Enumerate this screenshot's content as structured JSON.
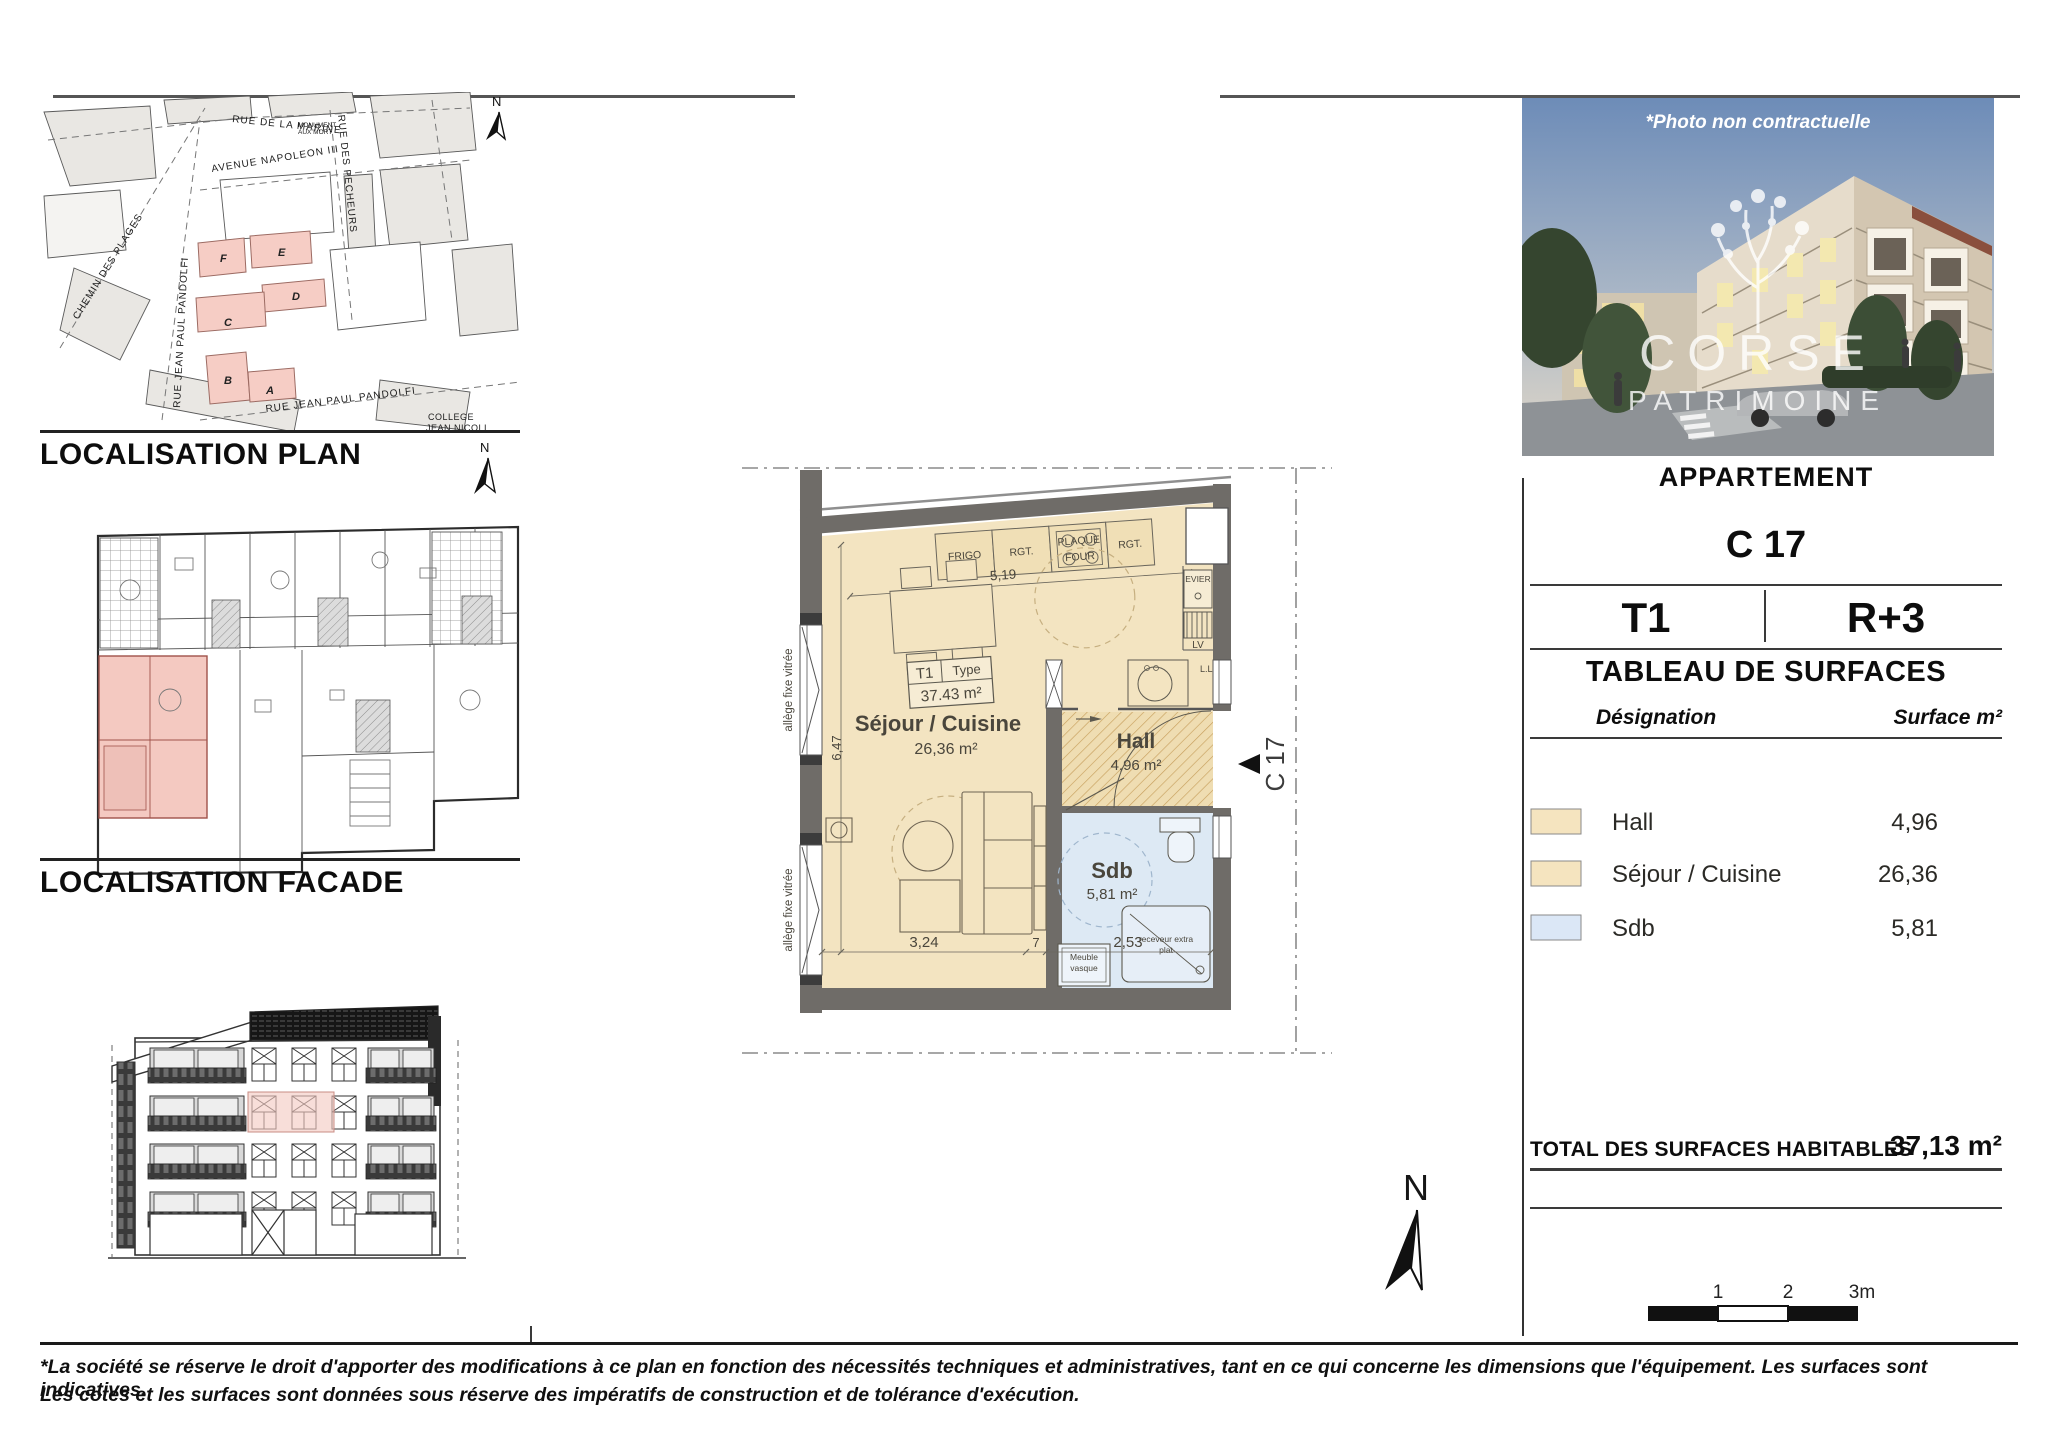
{
  "colors": {
    "room_tan": "#f3e4c1",
    "counter_tan": "#f0dfb6",
    "sdb_blue": "#dde9f4",
    "wall_gray": "#6f6c68",
    "pink_highlight": "#f4c9c1",
    "pink_border": "#a85b52",
    "map_block_gray": "#e9e7e3",
    "label_ink": "#4a463c"
  },
  "map": {
    "title": "LOCALISATION PLAN",
    "north_label": "N",
    "streets": {
      "marine": "RUE DE LA MARINE",
      "napoleon": "AVENUE  NAPOLEON  III",
      "monument_1": "MONUMENT",
      "monument_2": "AUX MORT",
      "chemin": "CHEMIN  DES  PLAGES",
      "pandolfi_v": "RUE  JEAN  PAUL  PANDOLFI",
      "pandolfi_d": "RUE   JEAN   PAUL   PANDOLFI",
      "pecheurs": "RUE  DES  PECHEURS",
      "college_1": "COLLEGE",
      "college_2": "JEAN NICOLI"
    },
    "buildings": {
      "a": "A",
      "b": "B",
      "c": "C",
      "d": "D",
      "e": "E",
      "f": "F"
    }
  },
  "facade": {
    "title": "LOCALISATION FACADE"
  },
  "photo": {
    "caption": "*Photo non contractuelle",
    "brand_top": "CORSE",
    "brand_bottom": "PATRIMOINE"
  },
  "plan": {
    "type_label": "T1",
    "type_word": "Type",
    "type_area": "37.43 m²",
    "sejour_label": "Séjour / Cuisine",
    "sejour_area": "26,36 m²",
    "hall_label": "Hall",
    "hall_area": "4,96 m²",
    "sdb_label": "Sdb",
    "sdb_area": "5,81 m²",
    "kitchen": {
      "frigo": "FRIGO",
      "rgt": "RGT.",
      "plaque_1": "PLAQUE",
      "plaque_2": "FOUR",
      "evier": "EVIER",
      "lv": "LV",
      "ll": "L.L"
    },
    "bath": {
      "meuble_1": "Meuble",
      "meuble_2": "vasque",
      "receveur_1": "receveur extra",
      "receveur_2": "plat"
    },
    "dims": {
      "top": "5,19",
      "left": "6,47",
      "b1": "3,24",
      "b2": "7",
      "b3": "2,53"
    },
    "allege": "allège fixe vitrée",
    "unit_tag": "C 17"
  },
  "panel": {
    "section_label": "APPARTEMENT",
    "unit": "C 17",
    "type": "T1",
    "floor": "R+3",
    "table_title": "TABLEAU DE SURFACES",
    "col_designation": "Désignation",
    "col_surface": "Surface m²",
    "rows": [
      {
        "label": "Hall",
        "value": "4,96",
        "color": "#f5e4bf"
      },
      {
        "label": "Séjour / Cuisine",
        "value": "26,36",
        "color": "#f5e4bf"
      },
      {
        "label": "Sdb",
        "value": "5,81",
        "color": "#dbe7f6"
      }
    ],
    "total_label": "TOTAL DES SURFACES HABITABLES",
    "total_value": "37,13 m²"
  },
  "compass": {
    "label": "N"
  },
  "scalebar": {
    "t1": "1",
    "t2": "2",
    "t3": "3m"
  },
  "footer": {
    "line1": "*La société se réserve le droit d'apporter des modifications à ce plan en fonction des nécessités techniques et administratives, tant en ce qui concerne les dimensions que l'équipement. Les surfaces sont indicatives.",
    "line2": "Les cotes et les surfaces sont données sous réserve des impératifs de construction et de tolérance d'exécution."
  }
}
